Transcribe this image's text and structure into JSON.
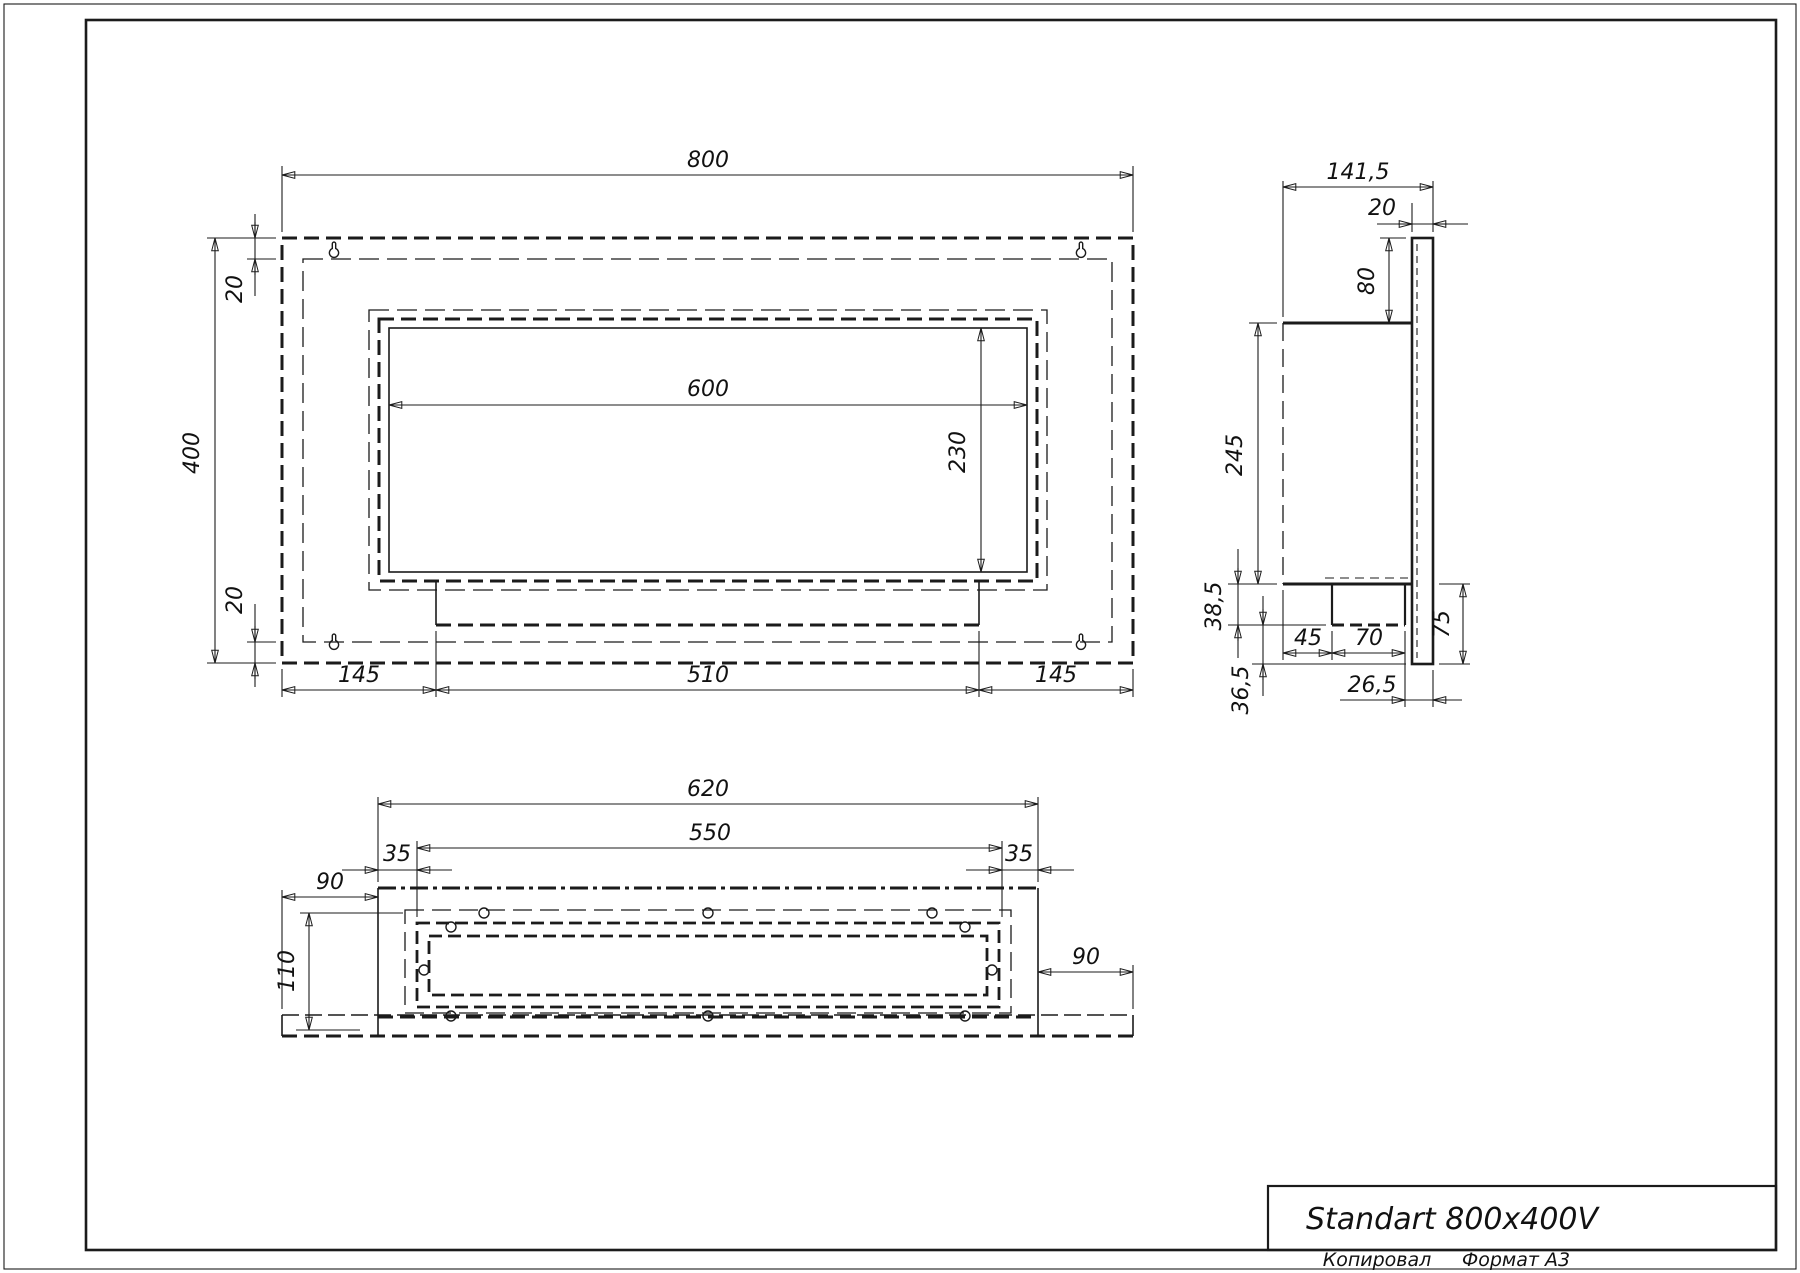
{
  "sheet": {
    "title": "Standart 800x400V",
    "footer_copied": "Копировал",
    "footer_format": "Формат A3",
    "line_color": "#1b1b1b",
    "background": "#ffffff"
  },
  "views": {
    "front": {
      "label": "front-view",
      "dims": {
        "width": "800",
        "height": "400",
        "top_offset": "20",
        "bottom_offset": "20",
        "opening_width": "600",
        "opening_height": "230",
        "margin_left": "145",
        "tray_width": "510",
        "margin_right": "145"
      }
    },
    "side": {
      "label": "side-view",
      "dims": {
        "depth": "141,5",
        "back_plate_thickness": "20",
        "top_drop": "80",
        "body_height": "245",
        "step_height": "38,5",
        "step_offset": "45",
        "step_width": "70",
        "lower_height": "75",
        "rear_gap": "26,5",
        "bottom_gap": "36,5"
      }
    },
    "bottom": {
      "label": "bottom-view",
      "dims": {
        "body_width": "620",
        "slot_width": "550",
        "margin_left": "35",
        "margin_right": "35",
        "plate_ext_left": "90",
        "inner_depth": "110",
        "plate_ext_right": "90"
      }
    }
  }
}
